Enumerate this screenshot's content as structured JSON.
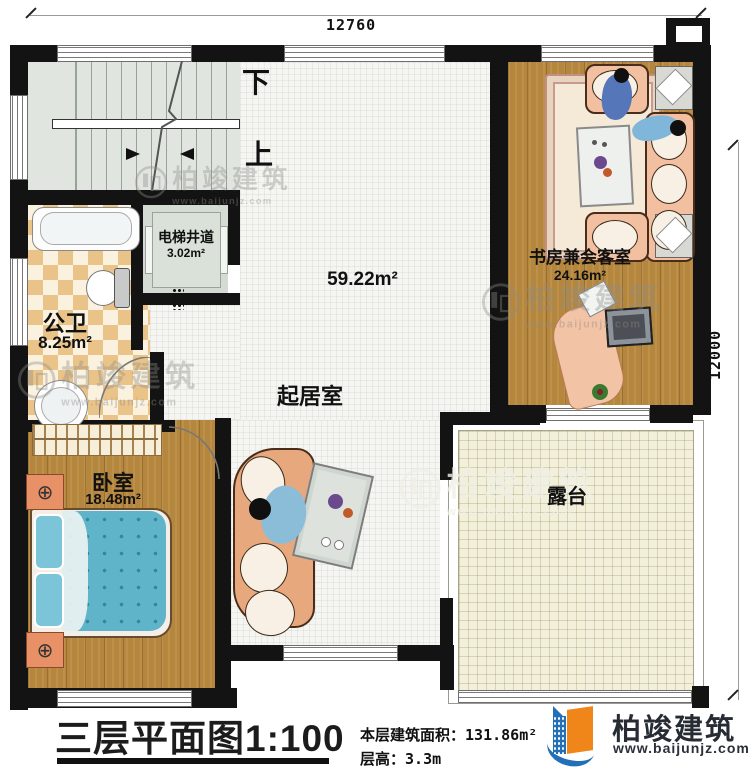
{
  "dimensions": {
    "top_width": "12760",
    "right_height": "12000"
  },
  "stairs": {
    "down_label": "下",
    "up_label": "上"
  },
  "rooms": {
    "elevator": {
      "name": "电梯井道",
      "area": "3.02m²"
    },
    "bathroom": {
      "name": "公卫",
      "area": "8.25m²"
    },
    "living": {
      "name": "起居室",
      "area": "59.22m²"
    },
    "study": {
      "name": "书房兼会客室",
      "area": "24.16m²"
    },
    "bedroom": {
      "name": "卧室",
      "area": "18.48m²"
    },
    "terrace": {
      "name": "露台"
    }
  },
  "watermark": {
    "text": "柏竣建筑",
    "url": "www.baijunjz.com"
  },
  "footer": {
    "plan_title": "三层平面图1:100",
    "area_label": "本层建筑面积：",
    "area_value": "131.86m²",
    "floor_height_label": "层高：",
    "floor_height_value": "3.3m"
  },
  "brand": {
    "name": "柏竣建筑",
    "website": "www.baijunjz.com"
  },
  "colors": {
    "wall": "#131313",
    "wood": "#b5873e",
    "tile": "#f5f5f1",
    "terrace": "#f2efda",
    "stair": "#e0e6df",
    "checker": "#eac389",
    "bed": "#5fb4c9",
    "sofa": "#f2c0a0",
    "brand_blue": "#2170b8",
    "brand_orange": "#f08519"
  }
}
